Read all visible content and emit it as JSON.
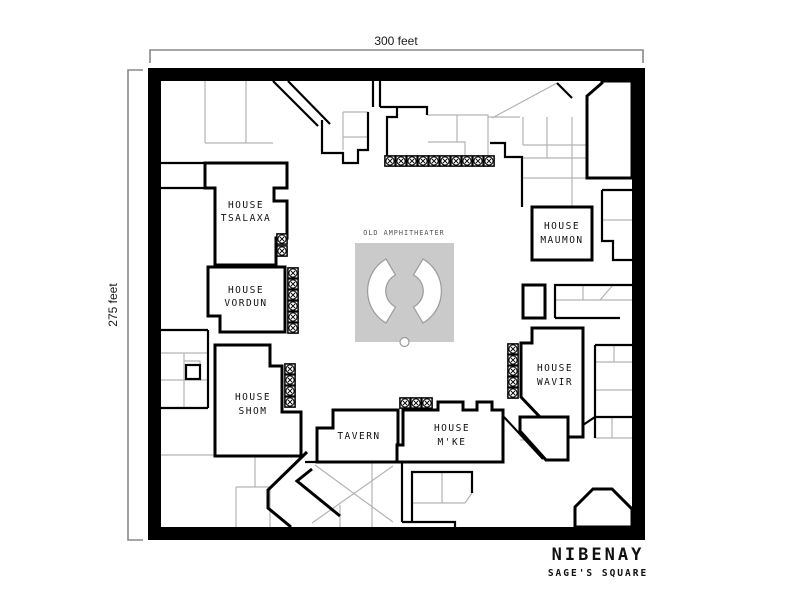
{
  "colors": {
    "ink": "#000000",
    "street_gray": "#b3b3b3",
    "plaza_fill": "#cacaca",
    "arc_stroke": "#9a9a9a",
    "scale_bracket": "#888888"
  },
  "scale_bars": {
    "top_label": "300 feet",
    "left_label": "275 feet"
  },
  "plaza": {
    "label": "OLD AMPHITHEATER"
  },
  "houses": {
    "tsalaxa": {
      "line1": "HOUSE",
      "line2": "TSALAXA"
    },
    "vordun": {
      "line1": "HOUSE",
      "line2": "VORDUN"
    },
    "shom": {
      "line1": "HOUSE",
      "line2": "SHOM"
    },
    "maumon": {
      "line1": "HOUSE",
      "line2": "MAUMON"
    },
    "wavir": {
      "line1": "HOUSE",
      "line2": "WAVIR"
    },
    "mke": {
      "line1": "HOUSE",
      "line2": "M'KE"
    },
    "tavern": {
      "label": "TAVERN"
    }
  },
  "caption": {
    "city": "NIBENAY",
    "district": "SAGE'S SQUARE"
  }
}
